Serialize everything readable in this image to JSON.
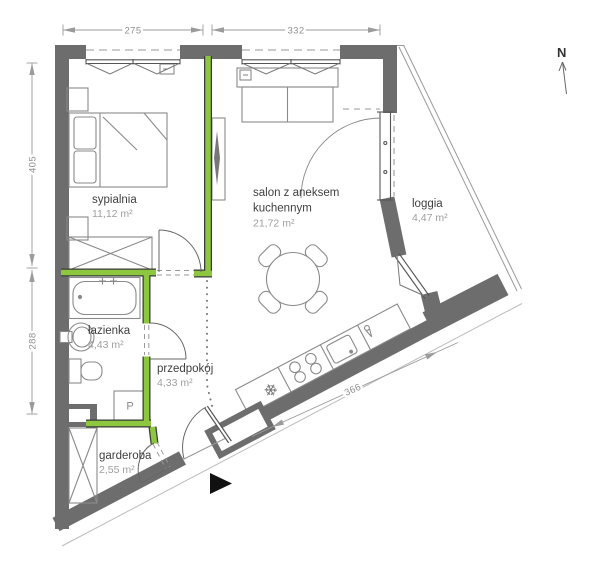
{
  "plan": {
    "compass": {
      "north": "N"
    },
    "rooms": {
      "bedroom": {
        "name": "sypialnia",
        "area": "11,12 m²"
      },
      "living_room": {
        "name_line1": "salon z aneksem",
        "name_line2": "kuchennym",
        "area": "21,72 m²"
      },
      "loggia": {
        "name": "loggia",
        "area": "4,47 m²"
      },
      "bathroom": {
        "name": "łazienka",
        "area": "4,43 m²"
      },
      "hallway": {
        "name": "przedpokój",
        "area": "4,33 m²"
      },
      "wardrobe_room": {
        "name": "garderoba",
        "area": "2,55 m²"
      }
    },
    "dimensions": {
      "top_bedroom_width": "275",
      "top_living_width": "332",
      "left_upper_height": "405",
      "left_lower_height": "288",
      "bottom_kitchen_wall": "366"
    },
    "appliances": {
      "washing_machine": "P",
      "fridge_snowflake": "❄"
    },
    "colors": {
      "wall_gray": "#6d6d6d",
      "partition_green": "#8dc63f",
      "furniture_line": "#8a8a8a",
      "room_name_text": "#3f3f3f",
      "room_area_text": "#9e9e9e",
      "dimension_text": "#8f8f8f"
    }
  }
}
